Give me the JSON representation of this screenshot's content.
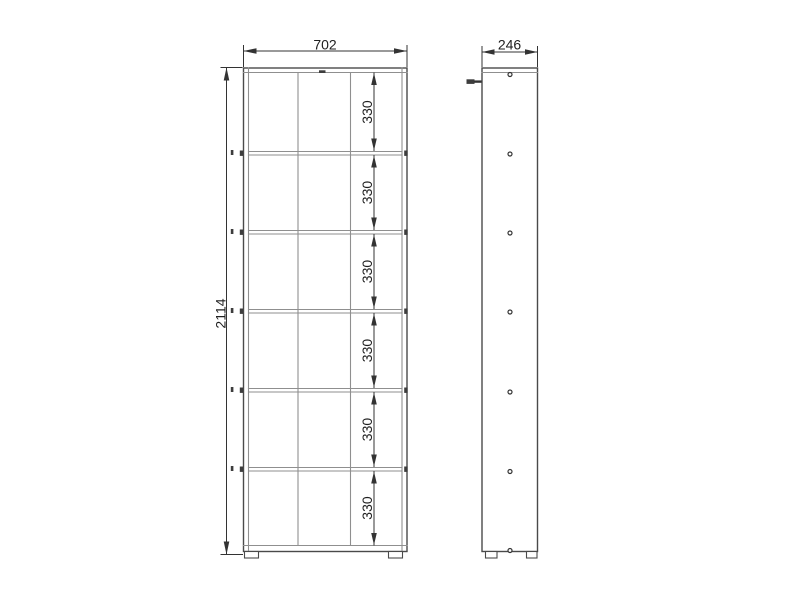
{
  "drawing_labels": {
    "front_width": "702",
    "front_height": "2114",
    "side_depth": "246",
    "compartments": [
      "330",
      "330",
      "330",
      "330",
      "330",
      "330"
    ]
  },
  "colors": {
    "background": "#ffffff",
    "outline": "#4a4a4a",
    "panel_line": "#8f8f8f",
    "dimension": "#333333",
    "text": "#1f1f1f"
  }
}
